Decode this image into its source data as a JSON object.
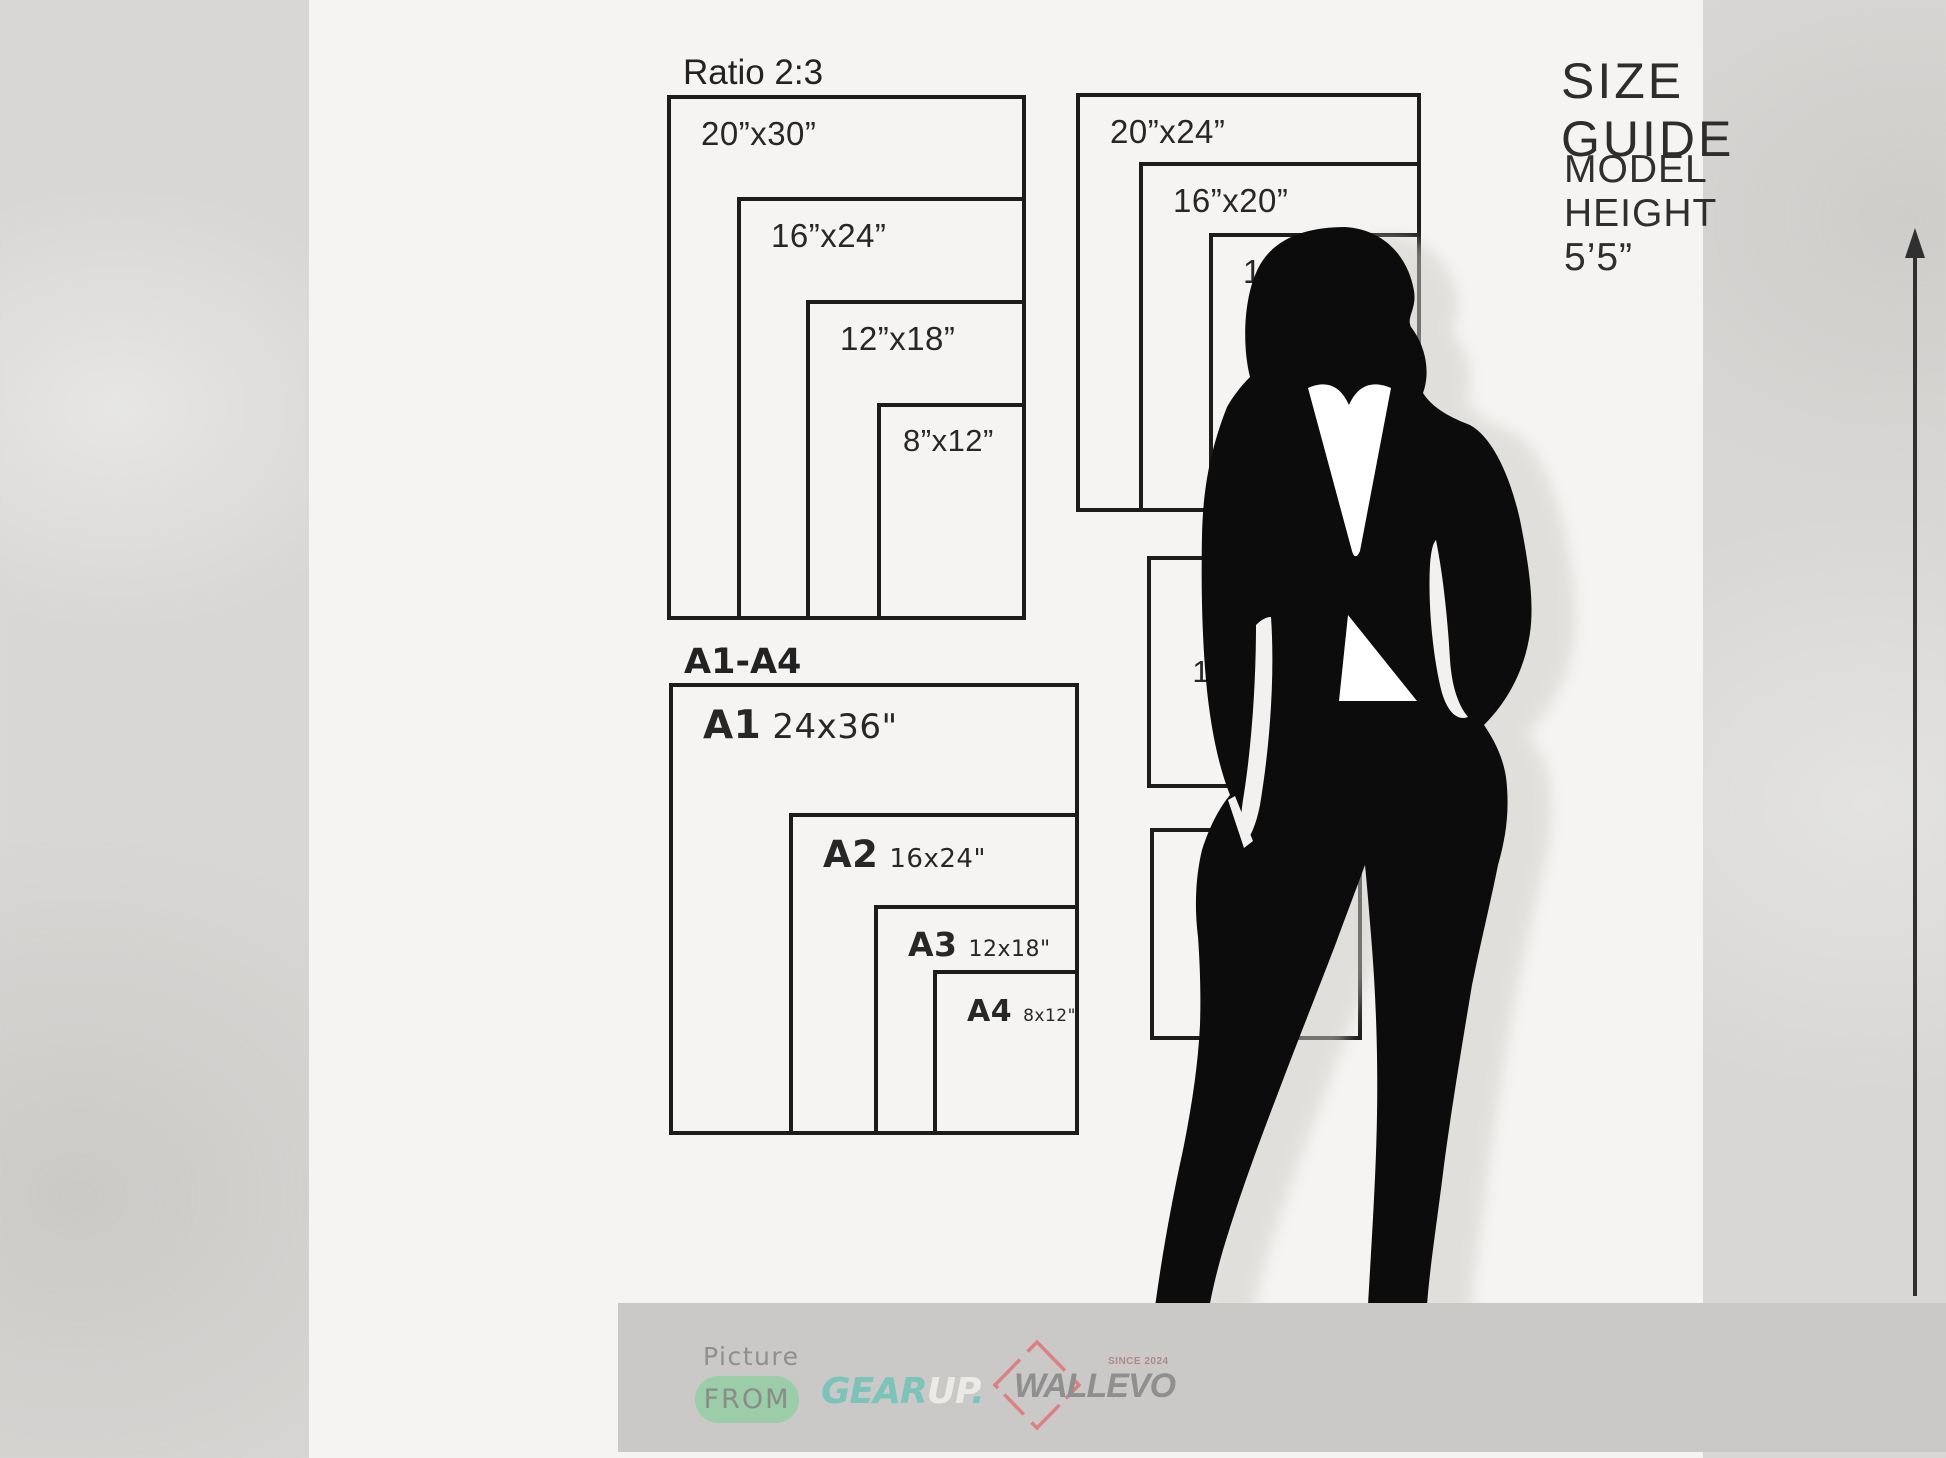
{
  "header": {
    "title": "SIZE GUIDE",
    "model_height": "MODEL HEIGHT 5’5”"
  },
  "ratio_group": {
    "title": "Ratio 2:3",
    "sizes": [
      "20”x30”",
      "16”x24”",
      "12”x18”",
      "8”x12”"
    ]
  },
  "portrait_group": {
    "sizes": [
      "20”x24”",
      "16”x20”",
      "12”x16”",
      "8”x10”"
    ]
  },
  "a_series": {
    "title": "A1-A4",
    "items": [
      {
        "name": "A1",
        "size": "24x36\""
      },
      {
        "name": "A2",
        "size": "16x24\""
      },
      {
        "name": "A3",
        "size": "12x18\""
      },
      {
        "name": "A4",
        "size": "8x12\""
      }
    ]
  },
  "single_boxes": [
    "11”x14”",
    "12”x12”"
  ],
  "footer": {
    "picture_label": "Picture",
    "from_label": "FROM",
    "gearup": {
      "gear": "GEAR",
      "up": "UP",
      "dot": "."
    },
    "wallevo": {
      "name": "WALLEVO",
      "since": "SINCE 2024"
    }
  },
  "colors": {
    "ink": "#1c1c1c",
    "background_gray": "#d8d7d5",
    "content_white": "#f5f4f2",
    "footer_band": "#cac9c8",
    "pill_green": "#9bcda8",
    "gear_teal": "#7cc4b9",
    "wallevo_salmon": "#dd8084",
    "logo_gray": "#8f8f8f"
  }
}
